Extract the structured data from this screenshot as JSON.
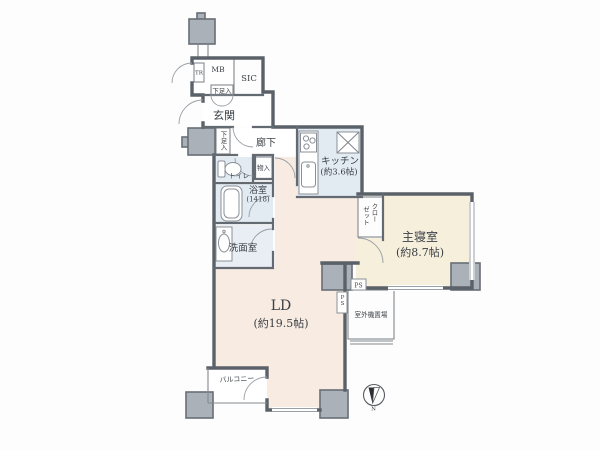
{
  "plan": {
    "type": "apartment-floor-plan",
    "colors": {
      "wall": "#5b6168",
      "pillar": "#abb1b9",
      "room_living": "#f8ebe2",
      "room_bedroom": "#f6efdb",
      "room_wet": "#e2eaf2",
      "room_storage": "#eaddc4",
      "background": "#fdfdfd",
      "text": "#3a3f45"
    },
    "rooms": {
      "ld": {
        "label": "LD",
        "size": "(約19.5帖)"
      },
      "bedroom": {
        "label": "主寝室",
        "size": "(約8.7帖)"
      },
      "kitchen": {
        "label": "キッチン",
        "size": "(約3.6帖)"
      },
      "bath": {
        "label": "浴室",
        "size": "(1418)"
      },
      "washroom": {
        "label": "洗面室"
      },
      "toilet": {
        "label": "トイレ"
      },
      "entrance": {
        "label": "玄関"
      },
      "hallway": {
        "label": "廊下"
      },
      "balcony": {
        "label": "バルコニー"
      },
      "closet": {
        "col1": "クロー",
        "col2": "ゼット"
      },
      "shoe_upper": {
        "label": "下足入"
      },
      "shoe_lower": {
        "label": "下足入"
      },
      "storage": {
        "label": "物入"
      },
      "sic": {
        "label": "SIC"
      },
      "mb": {
        "label": "MB"
      },
      "tr": {
        "label": "TR"
      },
      "outdoor_unit": {
        "label": "室外機置場"
      },
      "ps_a": {
        "label": "PS"
      },
      "ps_b": {
        "label": "PS"
      }
    },
    "compass": {
      "north_label": "N"
    }
  }
}
